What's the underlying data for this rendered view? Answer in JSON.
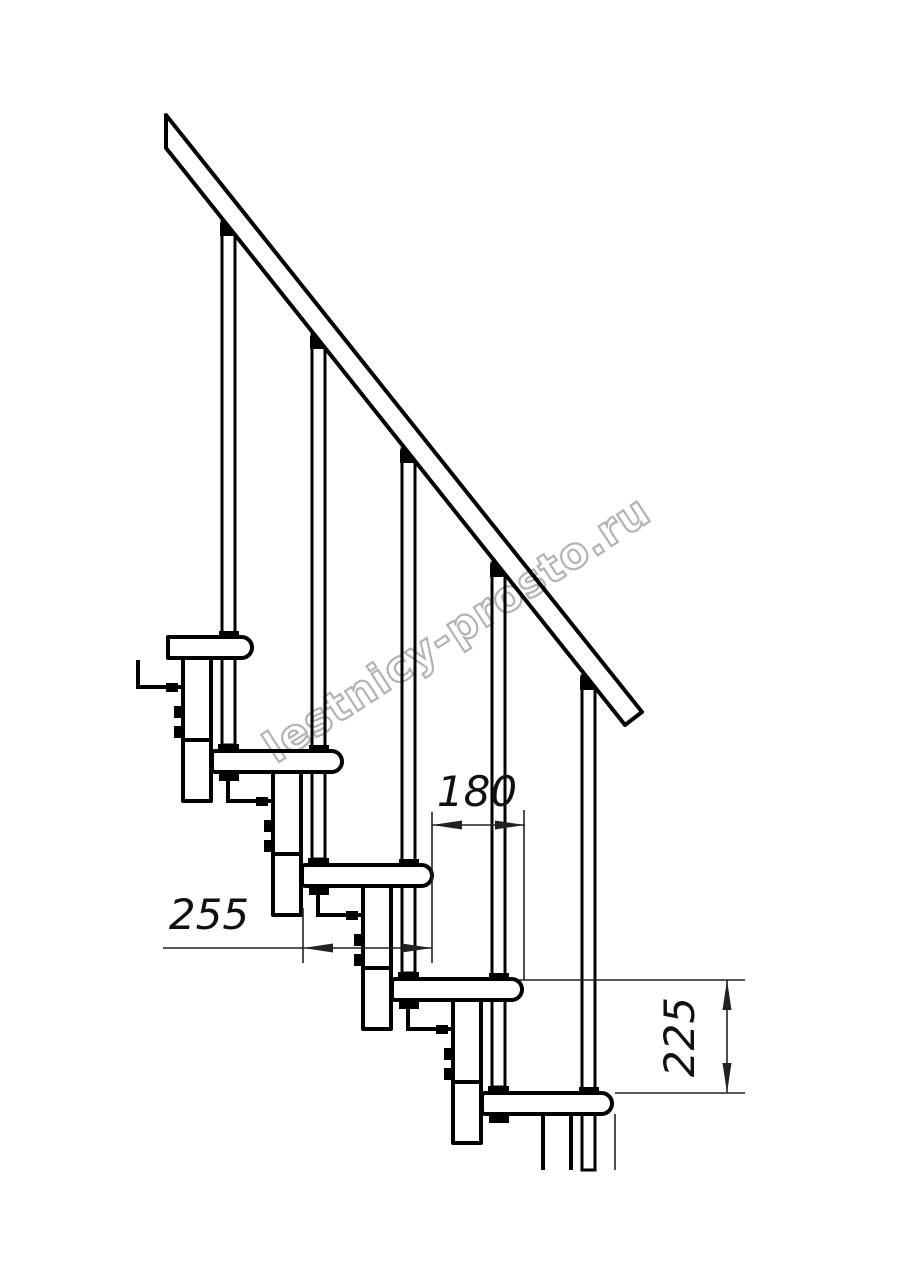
{
  "drawing": {
    "title": "modular-staircase-section",
    "watermark": "lestnicy-prosto.ru",
    "dimensions": {
      "step_run": "180",
      "tread_depth": "255",
      "step_rise": "225"
    },
    "colors": {
      "line": "#000000",
      "dim": "#222222",
      "watermark": "#b3b3b3",
      "background": "#ffffff"
    }
  }
}
